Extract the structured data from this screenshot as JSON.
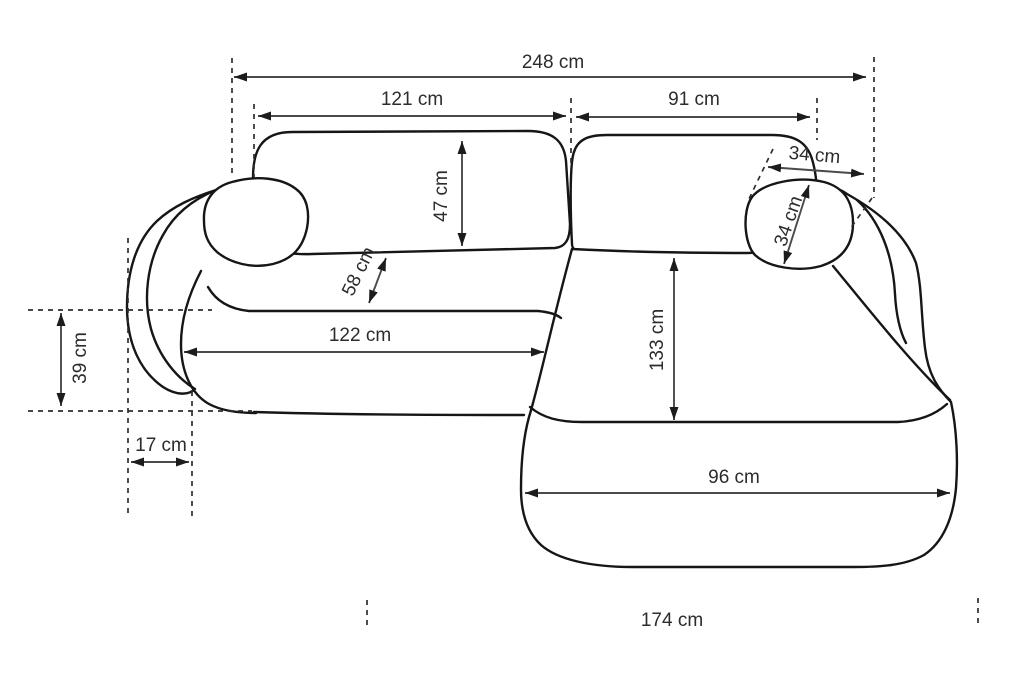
{
  "diagram": {
    "subject": "corner-sofa-dimension-drawing",
    "unit": "cm",
    "colors": {
      "background": "#ffffff",
      "outline": "#161616",
      "dimension_line": "#4a4a4a",
      "arrowhead": "#1c1c1c",
      "guide_dash": "#2e2e2e",
      "text": "#2c2c2c"
    },
    "dimensions": {
      "overall_width": {
        "value": 248,
        "label": "248 cm"
      },
      "left_back_width": {
        "value": 121,
        "label": "121 cm"
      },
      "right_back_width": {
        "value": 91,
        "label": "91 cm"
      },
      "back_cushion_depth": {
        "value": 47,
        "label": "47 cm"
      },
      "headrest_span": {
        "value": 34,
        "label": "34 cm"
      },
      "headrest_diagonal": {
        "value": 34,
        "label": "34 cm"
      },
      "seat_cushion_depth": {
        "value": 58,
        "label": "58 cm"
      },
      "seat_width": {
        "value": 122,
        "label": "122 cm"
      },
      "chaise_length": {
        "value": 133,
        "label": "133 cm"
      },
      "armrest_depth": {
        "value": 39,
        "label": "39 cm"
      },
      "armrest_width": {
        "value": 17,
        "label": "17 cm"
      },
      "chaise_width": {
        "value": 96,
        "label": "96 cm"
      },
      "total_depth": {
        "value": 174,
        "label": "174 cm"
      }
    }
  }
}
